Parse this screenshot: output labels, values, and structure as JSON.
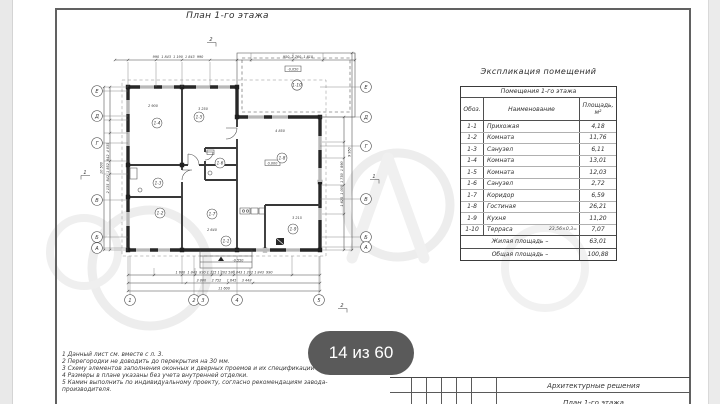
{
  "page": {
    "pagination_badge": "14 из 60"
  },
  "plan": {
    "title": "План 1-го этажа",
    "axes_left": [
      "Е",
      "Д",
      "Г",
      "В",
      "Б",
      "А"
    ],
    "axes_right": [
      "Е",
      "Д",
      "Г",
      "В",
      "Б",
      "А"
    ],
    "axes_bottom": [
      "1",
      "2",
      "3",
      "4",
      "5"
    ],
    "room_labels": [
      "1-1",
      "1-2",
      "1-3",
      "1-4",
      "1-5",
      "1-6",
      "1-7",
      "1-8",
      "1-9",
      "1-10"
    ],
    "section_marks": {
      "top": "2",
      "bottom": "2",
      "left": "1",
      "right": "1"
    },
    "elevations": {
      "main": "0,000",
      "terrace": "-0,050",
      "porch": "-0,550"
    },
    "interior_dims": [
      "2 900",
      "3 250",
      "4 850",
      "2 640",
      "3 215"
    ],
    "dims": {
      "top_left": "990  1 843  1 190  1 843  990",
      "top_right": "950  2 760  1 610",
      "bottom_row1": "1 680  1 843  830 1 115 1 202 580 843 1 202 1 843  990",
      "bottom_row2": "3 800     2 752     1 645     3 448",
      "bottom_total": "11 600",
      "left_chain": "2 135  842  1 852  842  4 035",
      "left_total": "10 500",
      "right_chain": "1 625  1 000  1 750  1 890",
      "right_total": "9 950"
    }
  },
  "table": {
    "title": "Экспликация помещений",
    "header_group": "Помещения 1-го этажа",
    "columns": [
      "Обоз.",
      "Наименование",
      "Площадь, м²"
    ],
    "rows": [
      [
        "1-1",
        "Прихожая",
        "4,18"
      ],
      [
        "1-2",
        "Комната",
        "11,76"
      ],
      [
        "1-3",
        "Санузел",
        "6,11"
      ],
      [
        "1-4",
        "Комната",
        "13,01"
      ],
      [
        "1-5",
        "Комната",
        "12,03"
      ],
      [
        "1-6",
        "Санузел",
        "2,72"
      ],
      [
        "1-7",
        "Коридор",
        "6,59"
      ],
      [
        "1-8",
        "Гостиная",
        "26,21"
      ],
      [
        "1-9",
        "Кухня",
        "11,20"
      ],
      [
        "1-10",
        "Терраса",
        "7,07"
      ]
    ],
    "terrace_note": "23,56×0,3=",
    "totals": [
      [
        "Жилая площадь –",
        "63,01"
      ],
      [
        "Общая площадь –",
        "100,88"
      ]
    ]
  },
  "notes": {
    "lines": [
      "1 Данный лист см. вместе с л. 3.",
      "2 Перегородки не доводить до перекрытия на 30 мм.",
      "3 Схему элементов заполнения оконных и дверных проемов и их спецификации см. л. 3.",
      "4 Размеры в плане указаны без учета внутренней отделки.",
      "5 Камин выполнить по индивидуальному проекту, согласно рекомендациям завода-",
      "производителя."
    ]
  },
  "title_block": {
    "department": "Архитектурные решения",
    "sheet_caption": "План 1-го этажа"
  }
}
